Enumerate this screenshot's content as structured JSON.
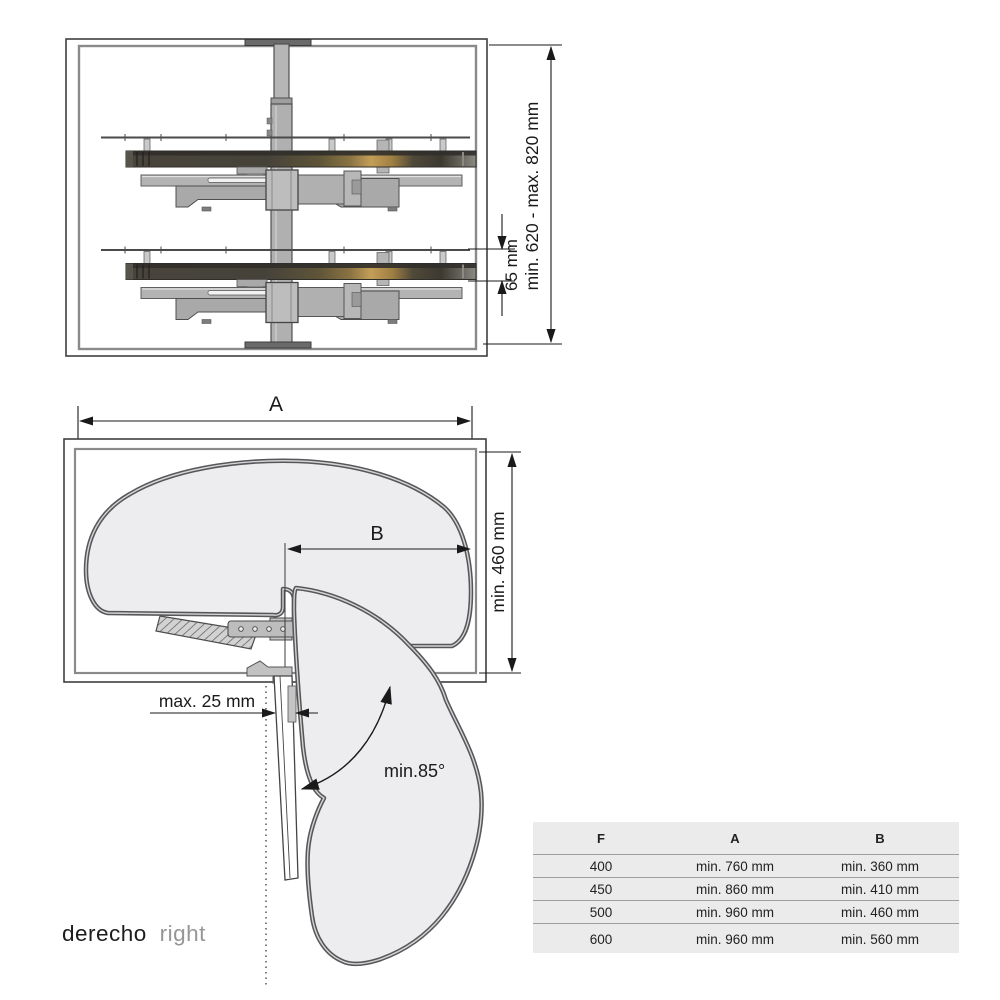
{
  "front_view": {
    "dim_height_label": "min. 620 - max. 820 mm",
    "dim_shelf_gap_label": "65 mm"
  },
  "top_view": {
    "dim_width_label": "A",
    "dim_inner_width_label": "B",
    "dim_depth_label": "min. 460 mm",
    "dim_door_gap_label": "max. 25 mm",
    "dim_swing_angle_label": "min.85°"
  },
  "caption": {
    "primary": "derecho",
    "secondary": "right"
  },
  "table": {
    "headers": {
      "f": "F",
      "a": "A",
      "b": "B"
    },
    "rows": [
      {
        "f": "400",
        "a": "min. 760 mm",
        "b": "min. 360 mm"
      },
      {
        "f": "450",
        "a": "min. 860 mm",
        "b": "min. 410 mm"
      },
      {
        "f": "500",
        "a": "min. 960 mm",
        "b": "min. 460 mm"
      },
      {
        "f": "600",
        "a": "min. 960 mm",
        "b": "min. 560 mm"
      }
    ]
  },
  "colors": {
    "line": "#1a1a1a",
    "cabinet_outline": "#3f3f3f",
    "cabinet_inner": "#8a8a8a",
    "shelf_fill": "#ededef",
    "shelf_edge": "#57575a",
    "metal_gray": "#b3b3b3",
    "wood_gold": "#c49e58",
    "table_bg": "#ebebeb"
  }
}
